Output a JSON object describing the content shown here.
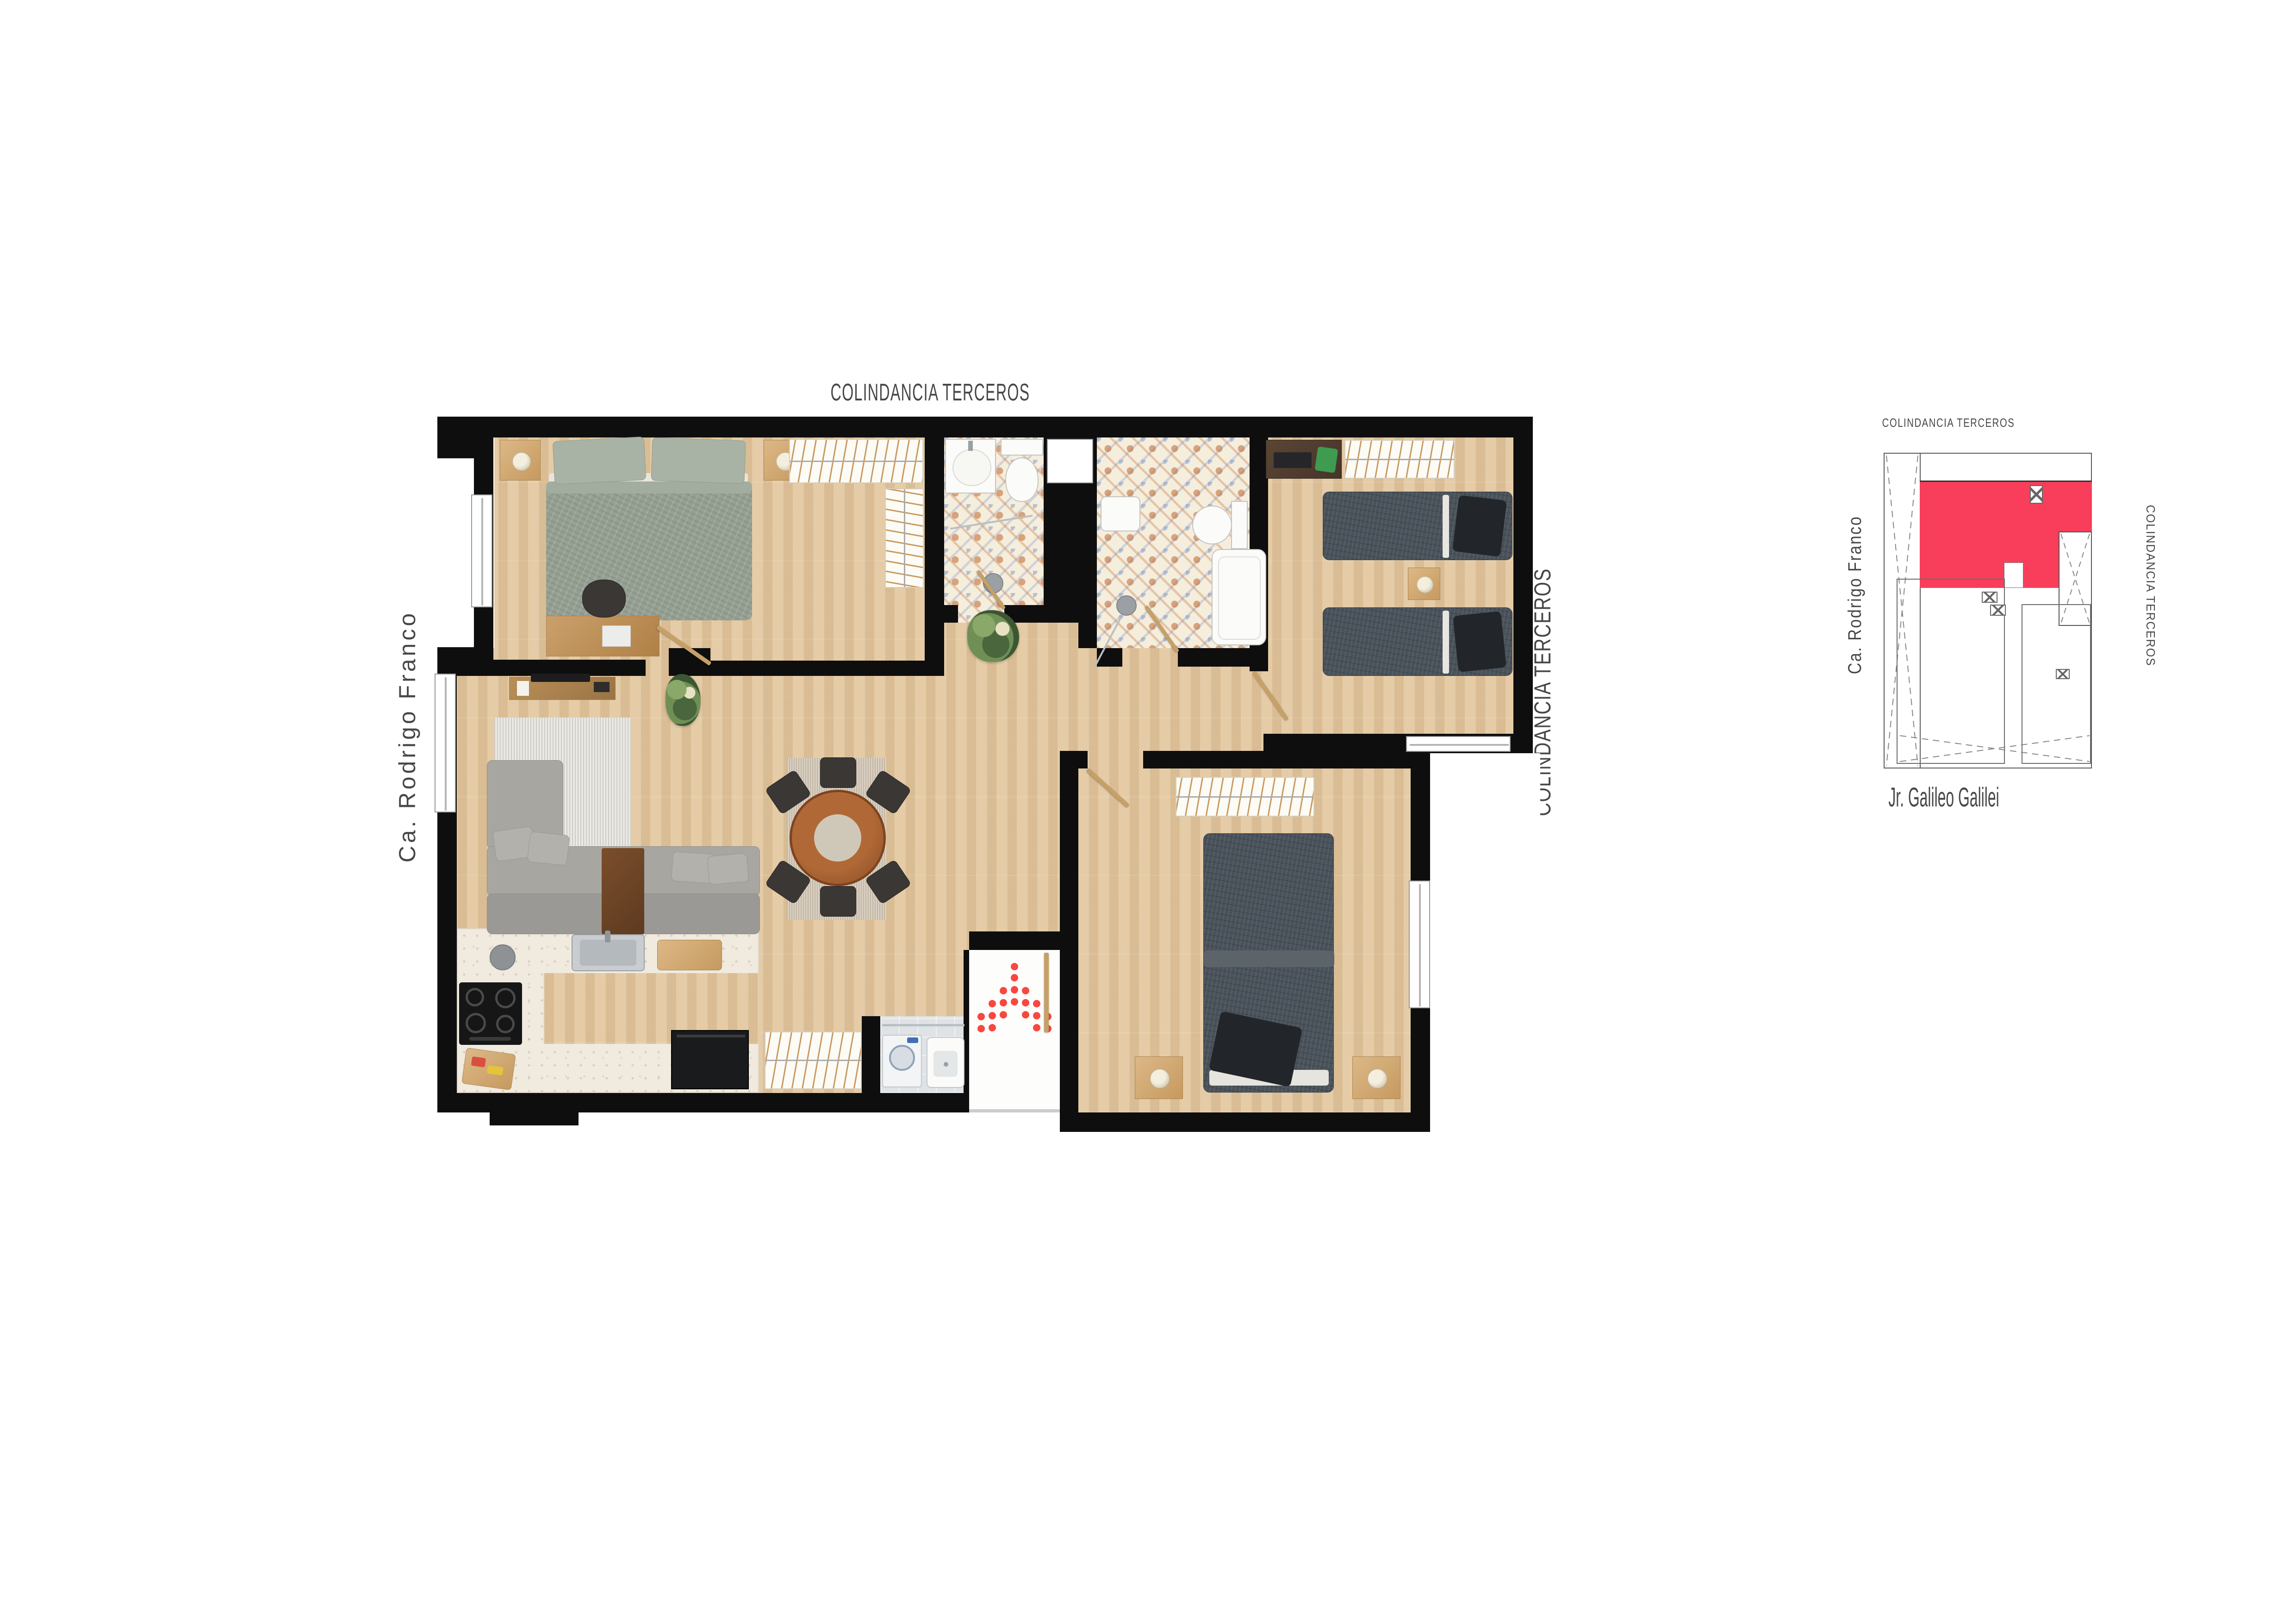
{
  "plan": {
    "label_top": "COLINDANCIA TERCEROS",
    "label_left": "Ca. Rodrigo Franco",
    "label_right": "COLINDANCIA TERCEROS"
  },
  "key_map": {
    "label_top": "COLINDANCIA TERCEROS",
    "label_left": "Ca. Rodrigo Franco",
    "label_right": "COLINDANCIA TERCEROS",
    "label_bottom": "Jr. Galileo Galilei"
  },
  "colors": {
    "wall": "#0e0e0e",
    "wood_floor": "#e3c9a2",
    "terrazzo": "#f0eadf",
    "tile_orange": "#c0662c",
    "tile_blue": "#7d92c2",
    "unit_highlight": "#f83e5b",
    "entry_arrow": "#f9473f",
    "label_text": "#474747"
  }
}
